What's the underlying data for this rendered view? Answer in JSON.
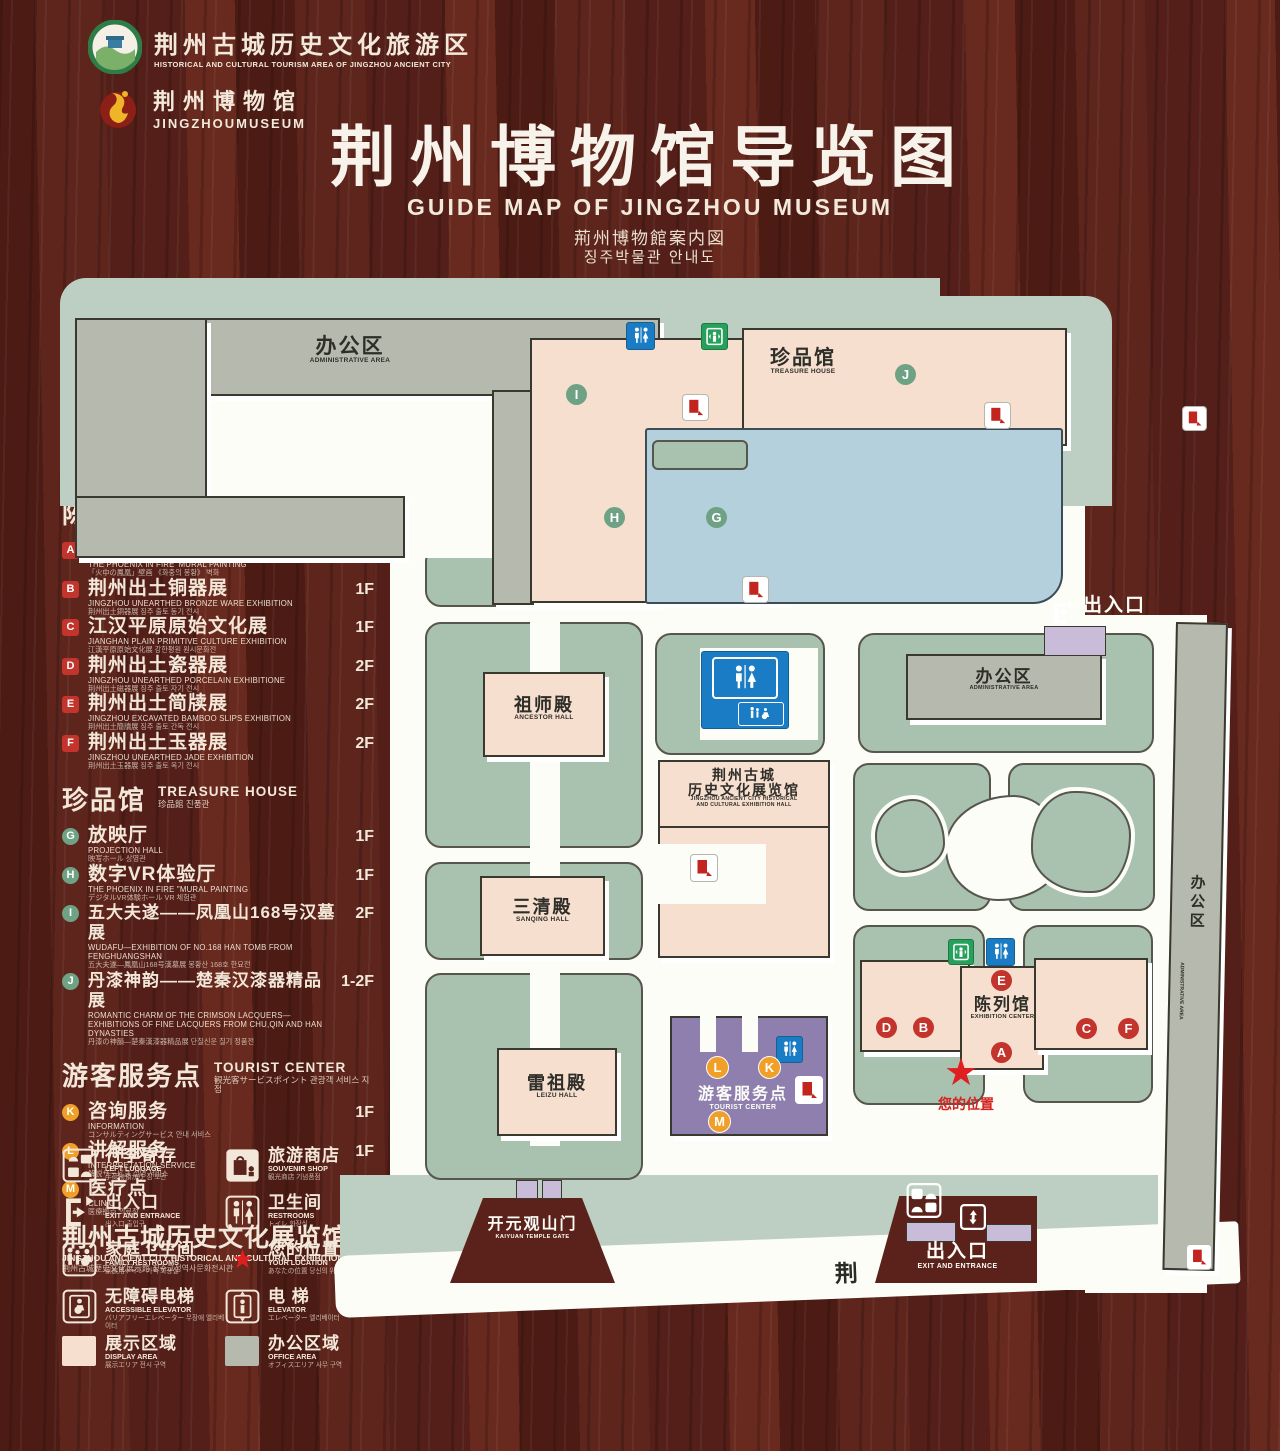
{
  "header": {
    "logo1_cn": "荆州古城历史文化旅游区",
    "logo1_en": "HISTORICAL AND CULTURAL TOURISM AREA OF JINGZHOU ANCIENT CITY",
    "logo2_cn": "荆州博物馆",
    "logo2_en": "JINGZHOUMUSEUM",
    "title_cn": "荆州博物馆导览图",
    "title_en": "GUIDE MAP OF JINGZHOU MUSEUM",
    "title_jp": "荊州博物館案内図",
    "title_kr": "징주박물관 안내도"
  },
  "legend": {
    "sections": [
      {
        "title_cn": "陈列馆",
        "title_en": "EXHIBITION CENTER",
        "title_sub": "陳列館  진열관",
        "items": [
          {
            "key": "A",
            "cn": "《火中的凤凰》壁画",
            "en": "THE PHOENIX IN FIRE 'MURAL PAINTING",
            "sub": "「火中の鳳凰」壁画  《화중의 봉황》 벽화",
            "floor": "1F"
          },
          {
            "key": "B",
            "cn": "荆州出土铜器展",
            "en": "JINGZHOU UNEARTHED BRONZE WARE EXHIBITION",
            "sub": "荆州出土銅器展  징주 출토 동기 전시",
            "floor": "1F"
          },
          {
            "key": "C",
            "cn": "江汉平原原始文化展",
            "en": "JIANGHAN PLAIN PRIMITIVE CULTURE EXHIBITION",
            "sub": "江漢平原原始文化展  강한평원 원시문화전",
            "floor": "1F"
          },
          {
            "key": "D",
            "cn": "荆州出土瓷器展",
            "en": "JINGZHOU UNEARTHED PORCELAIN EXHIBITIONE",
            "sub": "荆州出土磁器展  징주 출토 자기 전시",
            "floor": "2F"
          },
          {
            "key": "E",
            "cn": "荆州出土简牍展",
            "en": "JINGZHOU EXCAVATED BAMBOO SLIPS EXHIBITION",
            "sub": "荆州出土簡牘展  징주 출토 간독 전시",
            "floor": "2F"
          },
          {
            "key": "F",
            "cn": "荆州出土玉器展",
            "en": "JINGZHOU UNEARTHED JADE EXHIBITION",
            "sub": "荆州出土玉器展  징주 출토 옥기 전시",
            "floor": "2F"
          }
        ]
      },
      {
        "title_cn": "珍品馆",
        "title_en": "TREASURE HOUSE",
        "title_sub": "珍品館  진품관",
        "items": [
          {
            "key": "G",
            "cn": "放映厅",
            "en": "PROJECTION HALL",
            "sub": "映写ホール  상영관",
            "floor": "1F"
          },
          {
            "key": "H",
            "cn": "数字VR体验厅",
            "en": "THE PHOENIX IN FIRE \"MURAL PAINTING",
            "sub": "デジタルVR体験ホール  VR 체험관",
            "floor": "1F"
          },
          {
            "key": "I",
            "cn": "五大夫遂——凤凰山168号汉墓展",
            "en": "WUDAFU—EXHIBITION OF NO.168 HAN TOMB FROM FENGHUANGSHAN",
            "sub": "五大夫遂—鳳凰山168号漢墓展  봉황산 168호 한묘전",
            "floor": "2F"
          },
          {
            "key": "J",
            "cn": "丹漆神韵——楚秦汉漆器精品展",
            "en": "ROMANTIC CHARM OF THE CRIMSON LACQUERS— EXHIBITIONS OF FINE LACQUERS FROM CHU,QIN AND HAN DYNASTIES",
            "sub": "丹漆の神韻—楚秦漢漆器精品展  단칠신운 칠기 정품전",
            "floor": "1-2F"
          }
        ]
      },
      {
        "title_cn": "游客服务点",
        "title_en": "TOURIST CENTER",
        "title_sub": "観光客サービスポイント  관광객 서비스 지점",
        "items": [
          {
            "key": "K",
            "cn": "咨询服务",
            "en": "INFORMATION",
            "sub": "コンサルティングサービス  안내 서비스",
            "floor": "1F"
          },
          {
            "key": "L",
            "cn": "讲解服务",
            "en": "INTERPRETATION SERVICE",
            "sub": "解説サービス  설명 서비스",
            "floor": "1F"
          },
          {
            "key": "M",
            "cn": "医疗点",
            "en": "CLINIC",
            "sub": "医療拠点  의료점",
            "floor": "1F"
          }
        ]
      }
    ],
    "hall_cn": "荆州古城历史文化展览馆",
    "hall_en": "JINGZHOU ANCIENT CITY HISTORICAL AND CULTURAL EXHIBITION HALL",
    "hall_sub": "荆州古城歴史文化展示館    징주고성역사문화전시관",
    "facilities": [
      {
        "cn": "行李寄存",
        "en": "LEFT LUGGAGE",
        "sub": "手荷物預かり  짐 보관"
      },
      {
        "cn": "旅游商店",
        "en": "SOUVENIR SHOP",
        "sub": "観光商店  기념품점"
      },
      {
        "cn": "出入口",
        "en": "EXIT AND ENTRANCE",
        "sub": "出入口  출입구"
      },
      {
        "cn": "卫生间",
        "en": "RESTROOMS",
        "sub": "トイレ  화장실"
      },
      {
        "cn": "家庭卫生间",
        "en": "FAMILY RESTROOMS",
        "sub": "家族用トイレ  가족 화장실"
      },
      {
        "cn": "您的位置",
        "en": "YOUR LOCATION",
        "sub": "あなたの位置  당신의 위치"
      },
      {
        "cn": "无障碍电梯",
        "en": "ACCESSIBLE ELEVATOR",
        "sub": "バリアフリーエレベーター  무장애 엘리베이터"
      },
      {
        "cn": "电  梯",
        "en": "ELEVATOR",
        "sub": "エレベーター  엘리베이터"
      },
      {
        "cn": "展示区域",
        "en": "DISPLAY AREA",
        "sub": "展示エリア  전시 구역"
      },
      {
        "cn": "办公区域",
        "en": "OFFICE AREA",
        "sub": "オフィスエリア  사무 구역"
      }
    ]
  },
  "map": {
    "labels": {
      "admin_tl_cn": "办公区",
      "admin_tl_en": "ADMINISTRATIVE AREA",
      "treasure_cn": "珍品馆",
      "treasure_en": "TREASURE HOUSE",
      "ancestor_cn": "祖师殿",
      "ancestor_en": "ANCESTOR HALL",
      "sanqing_cn": "三清殿",
      "sanqing_en": "SANQING HALL",
      "leizu_cn": "雷祖殿",
      "leizu_en": "LEIZU HALL",
      "exh_hall_cn1": "荆州古城",
      "exh_hall_cn2": "历史文化展览馆",
      "exh_hall_en1": "JINGZHOU ANCIENT CITY HISTORICAL",
      "exh_hall_en2": "AND CULTURAL EXHIBITION HALL",
      "admin_r_cn": "办公区",
      "admin_r_en": "ADMINISTRATIVE AREA",
      "admin_strip_cn": "办公区",
      "admin_strip_en": "ADMINISTRATIVE AREA",
      "exit_tr_cn": "出入口",
      "exit_tr_en": "EXIT AND ENTRANCE",
      "exit_b_cn": "出入口",
      "exit_b_en": "EXIT AND ENTRANCE",
      "exh_center_cn": "陈列馆",
      "exh_center_en": "EXHIBITION CENTER",
      "tourist_cn": "游客服务点",
      "tourist_en": "TOURIST CENTER",
      "gate_cn": "开元观山门",
      "gate_en": "KAIYUAN TEMPLE GATE",
      "your_location": "您的位置",
      "road": "荆 州 中 路",
      "location_star": "★"
    },
    "badges": {
      "a": "A",
      "b": "B",
      "c": "C",
      "d": "D",
      "e": "E",
      "f": "F",
      "g": "G",
      "h": "H",
      "i": "I",
      "j": "J",
      "k": "K",
      "l": "L",
      "m": "M"
    }
  },
  "colors": {
    "wood_bg": "#551f18",
    "map_green": "#bccfc2",
    "landscape_green": "#a9c2af",
    "display_area_pink": "#f7dfd0",
    "office_area_gray": "#b6b9ad",
    "lake_blue": "#b4d0dc",
    "tourist_purple": "#8e7fae",
    "gate_purple": "#c9bcd9",
    "badge_red": "#c2342c",
    "badge_green": "#6fa284",
    "badge_orange": "#f0a028",
    "restroom_blue": "#1a7cc4",
    "elevator_green": "#27a05c",
    "location_red": "#e02020"
  }
}
